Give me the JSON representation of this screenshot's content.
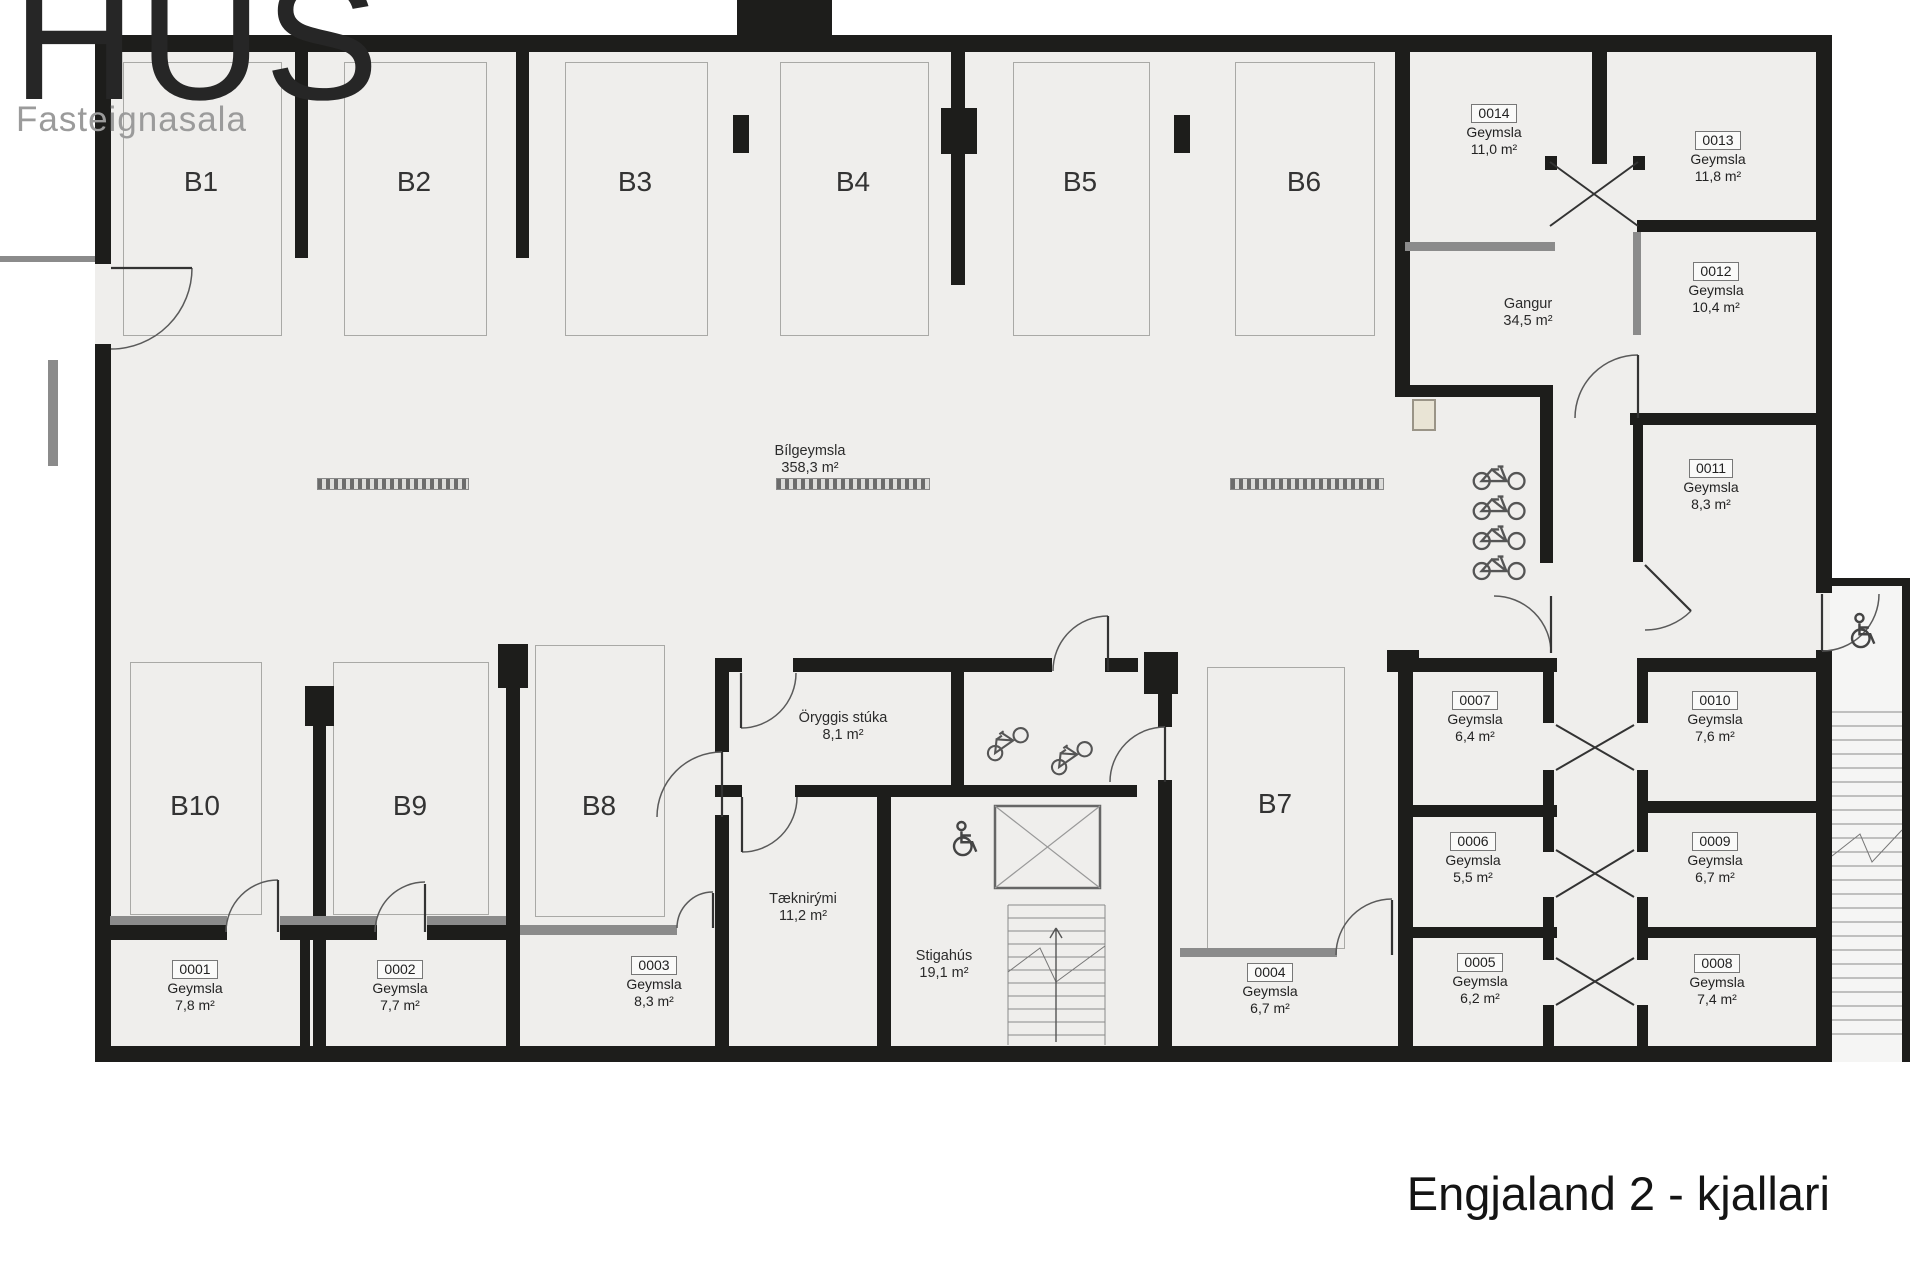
{
  "logo": {
    "brand": "HÚS",
    "subtitle": "Fasteignasala"
  },
  "plan_title": "Engjaland 2 - kjallari",
  "areas": {
    "garage": {
      "name": "Bílgeymsla",
      "area": "358,3 m²"
    },
    "corridor": {
      "name": "Gangur",
      "area": "34,5 m²"
    },
    "security": {
      "name": "Öryggis stúka",
      "area": "8,1 m²"
    },
    "technical": {
      "name": "Tæknirými",
      "area": "11,2 m²"
    },
    "stairwell": {
      "name": "Stigahús",
      "area": "19,1 m²"
    }
  },
  "parking": [
    "B1",
    "B2",
    "B3",
    "B4",
    "B5",
    "B6",
    "B7",
    "B8",
    "B9",
    "B10"
  ],
  "rooms": [
    {
      "id": "0001",
      "type": "Geymsla",
      "area": "7,8 m²"
    },
    {
      "id": "0002",
      "type": "Geymsla",
      "area": "7,7 m²"
    },
    {
      "id": "0003",
      "type": "Geymsla",
      "area": "8,3 m²"
    },
    {
      "id": "0004",
      "type": "Geymsla",
      "area": "6,7 m²"
    },
    {
      "id": "0005",
      "type": "Geymsla",
      "area": "6,2 m²"
    },
    {
      "id": "0006",
      "type": "Geymsla",
      "area": "5,5 m²"
    },
    {
      "id": "0007",
      "type": "Geymsla",
      "area": "6,4 m²"
    },
    {
      "id": "0008",
      "type": "Geymsla",
      "area": "7,4 m²"
    },
    {
      "id": "0009",
      "type": "Geymsla",
      "area": "6,7 m²"
    },
    {
      "id": "0010",
      "type": "Geymsla",
      "area": "7,6 m²"
    },
    {
      "id": "0011",
      "type": "Geymsla",
      "area": "8,3 m²"
    },
    {
      "id": "0012",
      "type": "Geymsla",
      "area": "10,4 m²"
    },
    {
      "id": "0013",
      "type": "Geymsla",
      "area": "11,8 m²"
    },
    {
      "id": "0014",
      "type": "Geymsla",
      "area": "11,0 m²"
    }
  ],
  "colors": {
    "wall": "#1d1d1b",
    "wall_gray": "#8b8b8b",
    "floor": "#efeeec",
    "logo_gray": "#9b9b9b"
  }
}
